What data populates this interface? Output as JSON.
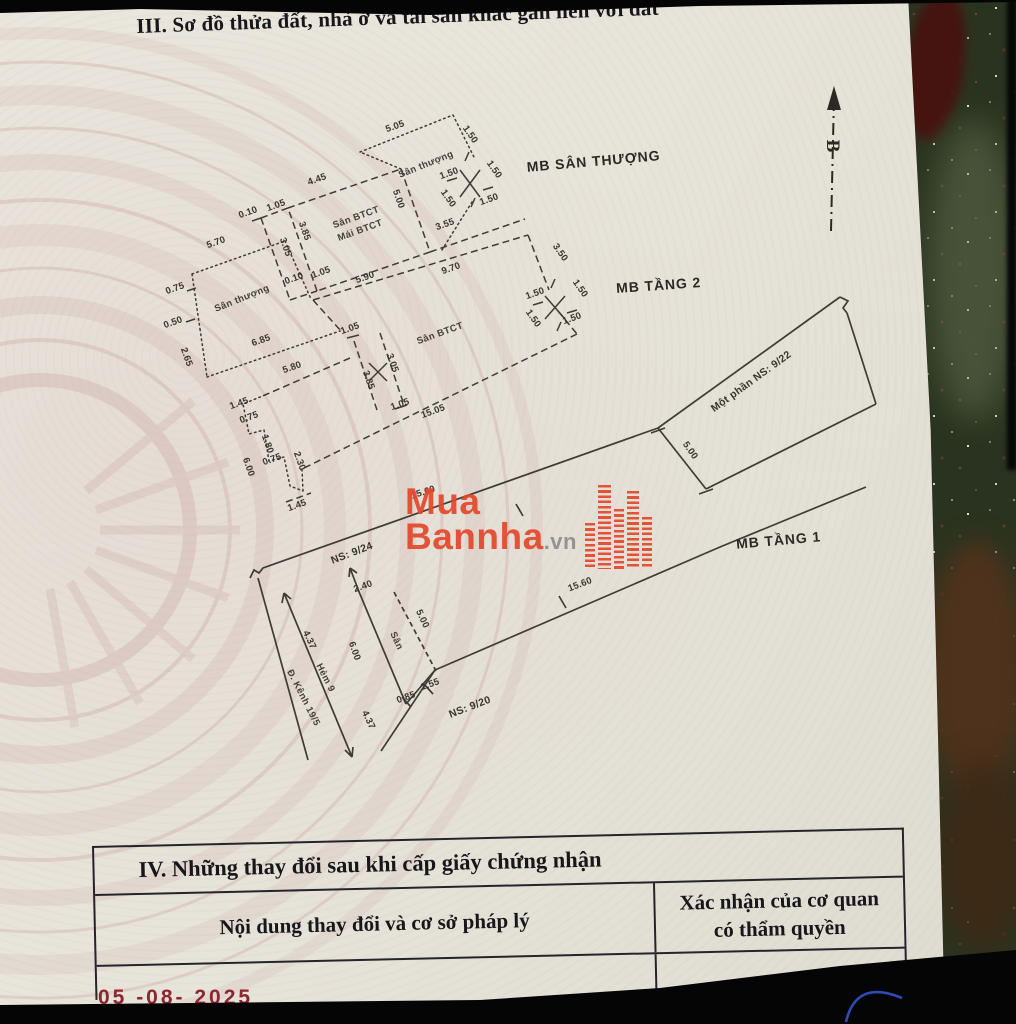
{
  "page": {
    "section_iii_title": "III. Sơ đồ thửa đất, nhà ở và tài sản khác gắn liền với đất",
    "section_iv": {
      "title": "IV. Những thay đổi sau khi cấp giấy chứng nhận",
      "col_left": "Nội dung thay đổi và cơ sở pháp lý",
      "col_right_line1": "Xác nhận của cơ quan",
      "col_right_line2": "có thẩm quyền"
    },
    "date_stamp": "05 -08- 2025"
  },
  "compass": {
    "north_label": "B"
  },
  "watermark": {
    "line1": "Mua",
    "line2": "Bannha",
    "suffix": ".vn",
    "brand_red": "#e4472b"
  },
  "colors": {
    "paper": "#e7e4da",
    "ink": "#3f3b35",
    "emblem_pink": "#c89e9e",
    "stamp_red": "#8c2730",
    "pen_blue": "#3653c9"
  },
  "plans": {
    "san_thuong": {
      "name": "MB SÂN THƯỢNG",
      "labels": [
        {
          "t": "5.05",
          "x": 396,
          "y": 129,
          "r": -20
        },
        {
          "t": "1.50",
          "x": 468,
          "y": 136,
          "r": 55
        },
        {
          "t": "Sân thượng",
          "x": 427,
          "y": 167,
          "r": -22,
          "k": "room"
        },
        {
          "t": "1.50",
          "x": 450,
          "y": 176,
          "r": -20
        },
        {
          "t": "1.50",
          "x": 492,
          "y": 171,
          "r": 55
        },
        {
          "t": "1.50",
          "x": 446,
          "y": 200,
          "r": 55
        },
        {
          "t": "1.50",
          "x": 490,
          "y": 202,
          "r": -20
        },
        {
          "t": "4.45",
          "x": 318,
          "y": 182,
          "r": -20
        },
        {
          "t": "0.10",
          "x": 249,
          "y": 215,
          "r": -20
        },
        {
          "t": "1.05",
          "x": 277,
          "y": 208,
          "r": -20
        },
        {
          "t": "Sân BTCT",
          "x": 357,
          "y": 220,
          "r": -20,
          "k": "room"
        },
        {
          "t": "Mái BTCT",
          "x": 361,
          "y": 233,
          "r": -20,
          "k": "room"
        },
        {
          "t": "5.00",
          "x": 396,
          "y": 200,
          "r": 70
        },
        {
          "t": "3.85",
          "x": 302,
          "y": 232,
          "r": 70
        },
        {
          "t": "3.05",
          "x": 283,
          "y": 248,
          "r": 70
        },
        {
          "t": "3.55",
          "x": 446,
          "y": 227,
          "r": -20
        },
        {
          "t": "MB SÂN THƯỢNG",
          "x": 594,
          "y": 166,
          "r": -5,
          "k": "plan"
        }
      ]
    },
    "tang2": {
      "name": "MB TẦNG 2",
      "labels": [
        {
          "t": "5.70",
          "x": 217,
          "y": 245,
          "r": -20
        },
        {
          "t": "0.75",
          "x": 176,
          "y": 291,
          "r": -20
        },
        {
          "t": "0.50",
          "x": 174,
          "y": 325,
          "r": -20
        },
        {
          "t": "2.65",
          "x": 184,
          "y": 358,
          "r": 70
        },
        {
          "t": "Sân thượng",
          "x": 243,
          "y": 301,
          "r": -22,
          "k": "room"
        },
        {
          "t": "6.85",
          "x": 262,
          "y": 343,
          "r": -20
        },
        {
          "t": "0.10",
          "x": 295,
          "y": 281,
          "r": -20
        },
        {
          "t": "1.05",
          "x": 322,
          "y": 275,
          "r": -20
        },
        {
          "t": "5.90",
          "x": 366,
          "y": 280,
          "r": -20
        },
        {
          "t": "9.70",
          "x": 452,
          "y": 271,
          "r": -20
        },
        {
          "t": "3.50",
          "x": 558,
          "y": 254,
          "r": 55
        },
        {
          "t": "1.50",
          "x": 536,
          "y": 296,
          "r": -20
        },
        {
          "t": "1.50",
          "x": 578,
          "y": 290,
          "r": 55
        },
        {
          "t": "1.50",
          "x": 531,
          "y": 320,
          "r": 55
        },
        {
          "t": "1.50",
          "x": 573,
          "y": 321,
          "r": -20
        },
        {
          "t": "Sân BTCT",
          "x": 441,
          "y": 336,
          "r": -20,
          "k": "room"
        },
        {
          "t": "1.05",
          "x": 351,
          "y": 331,
          "r": -20
        },
        {
          "t": "3.85",
          "x": 366,
          "y": 381,
          "r": 70
        },
        {
          "t": "3.05",
          "x": 390,
          "y": 364,
          "r": 70
        },
        {
          "t": "1.05",
          "x": 401,
          "y": 407,
          "r": -20
        },
        {
          "t": "5.80",
          "x": 293,
          "y": 370,
          "r": -20
        },
        {
          "t": "15.05",
          "x": 434,
          "y": 414,
          "r": -20
        },
        {
          "t": "1.45",
          "x": 240,
          "y": 406,
          "r": -20
        },
        {
          "t": "0.75",
          "x": 250,
          "y": 420,
          "r": -20
        },
        {
          "t": "1.80",
          "x": 265,
          "y": 445,
          "r": 70
        },
        {
          "t": "0.75",
          "x": 273,
          "y": 462,
          "r": -20
        },
        {
          "t": "2.30",
          "x": 297,
          "y": 462,
          "r": 70
        },
        {
          "t": "6.00",
          "x": 246,
          "y": 468,
          "r": 70
        },
        {
          "t": "1.45",
          "x": 298,
          "y": 508,
          "r": -20
        },
        {
          "t": "MB TẦNG 2",
          "x": 659,
          "y": 290,
          "r": -4,
          "k": "plan"
        }
      ]
    },
    "tang1": {
      "name": "MB TẦNG 1",
      "labels": [
        {
          "t": "Một phần NS: 9/22",
          "x": 753,
          "y": 384,
          "r": -36,
          "k": "bound"
        },
        {
          "t": "5.00",
          "x": 688,
          "y": 452,
          "r": 55
        },
        {
          "t": "NS: 9/24",
          "x": 353,
          "y": 556,
          "r": -21,
          "k": "bound"
        },
        {
          "t": "15.60",
          "x": 424,
          "y": 495,
          "r": -18
        },
        {
          "t": "15.60",
          "x": 581,
          "y": 587,
          "r": -21
        },
        {
          "t": "2.40",
          "x": 364,
          "y": 589,
          "r": -20
        },
        {
          "t": "5.00",
          "x": 420,
          "y": 620,
          "r": 65
        },
        {
          "t": "Sân",
          "x": 394,
          "y": 642,
          "r": 65,
          "k": "room"
        },
        {
          "t": "6.00",
          "x": 352,
          "y": 652,
          "r": 70
        },
        {
          "t": "4.37",
          "x": 307,
          "y": 641,
          "r": 65
        },
        {
          "t": "4.37",
          "x": 366,
          "y": 721,
          "r": 65
        },
        {
          "t": "Hẻm 9",
          "x": 323,
          "y": 679,
          "r": 63,
          "k": "room"
        },
        {
          "t": "Đ. Kênh 19/5",
          "x": 301,
          "y": 699,
          "r": 63,
          "k": "room"
        },
        {
          "t": "0.85",
          "x": 407,
          "y": 700,
          "r": -20
        },
        {
          "t": "1.55",
          "x": 431,
          "y": 687,
          "r": -20
        },
        {
          "t": "NS: 9/20",
          "x": 471,
          "y": 710,
          "r": -21,
          "k": "bound"
        },
        {
          "t": "MB TẦNG 1",
          "x": 779,
          "y": 545,
          "r": -5,
          "k": "plan"
        }
      ]
    }
  }
}
